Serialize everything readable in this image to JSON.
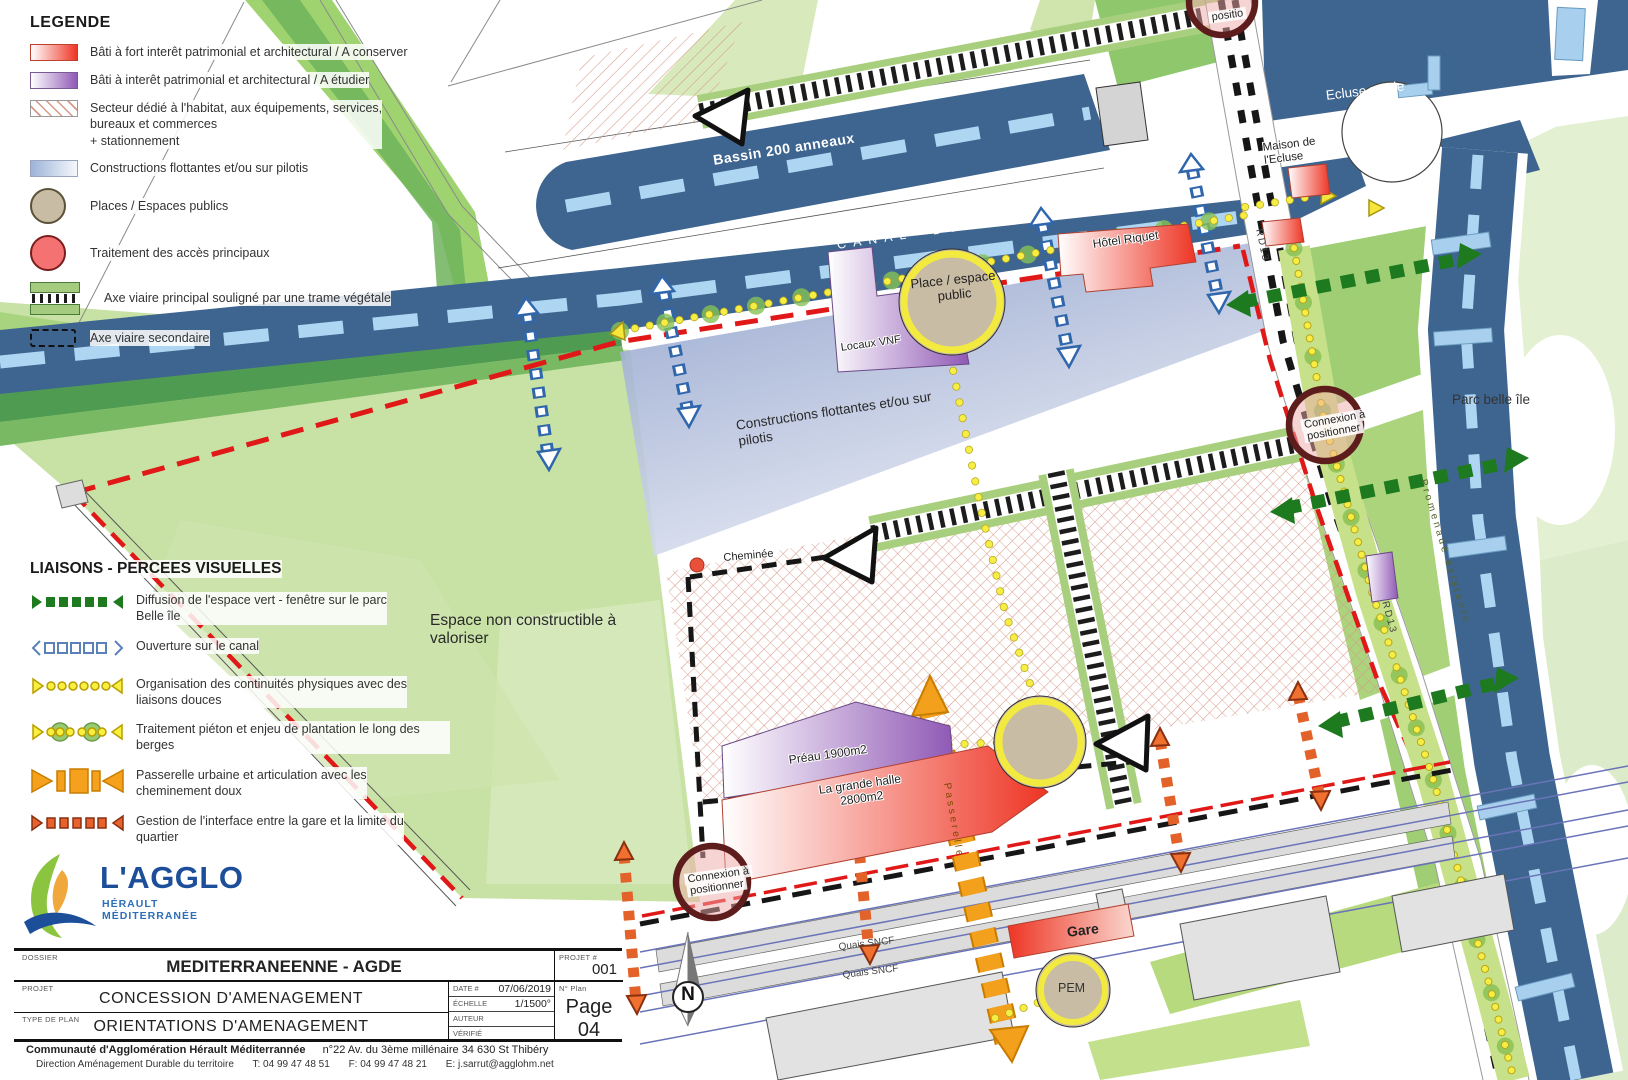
{
  "legend": {
    "title": "LEGENDE",
    "items": [
      {
        "icon": "red-gradient-swatch",
        "label": "Bâti à fort interêt patrimonial et architectural / A conserver"
      },
      {
        "icon": "purple-gradient-swatch",
        "label": "Bâti à interêt patrimonial et architectural / A étudier"
      },
      {
        "icon": "hatched-swatch",
        "label": "Secteur dédié à l'habitat, aux équipements, services,\nbureaux et commerces\n+ stationnement"
      },
      {
        "icon": "blue-gradient-swatch",
        "label": "Constructions flottantes et/ou sur pilotis"
      },
      {
        "icon": "tan-circle-swatch",
        "label": "Places / Espaces publics"
      },
      {
        "icon": "pink-circle-swatch",
        "label": "Traitement des accès principaux"
      },
      {
        "icon": "ladder-swatch",
        "label": "Axe viaire principal souligné par une trame végétale"
      },
      {
        "icon": "dashed-rect-swatch",
        "label": "Axe viaire secondaire"
      }
    ]
  },
  "liaisons": {
    "title": "LIAISONS - PERCEES VISUELLES",
    "items": [
      {
        "icon": "green-dashed-arrow",
        "label": "Diffusion de l'espace vert - fenêtre sur le parc\nBelle île"
      },
      {
        "icon": "blue-squares-arrow",
        "label": "Ouverture sur le canal"
      },
      {
        "icon": "yellow-dots-arrow",
        "label": "Organisation des continuités physiques avec des\nliaisons douces"
      },
      {
        "icon": "yellow-trees-arrow",
        "label": "Traitement piéton et enjeu de plantation le long des berges"
      },
      {
        "icon": "orange-bridge-arrow",
        "label": "Passerelle urbaine et articulation avec les\ncheminement doux"
      },
      {
        "icon": "orange-squares-arrow",
        "label": "Gestion de l'interface entre la gare et la limite du\nquartier"
      }
    ]
  },
  "map_labels": {
    "bassin": "Bassin 200 anneaux",
    "canal": "CANAL DU MIDI",
    "ecluse_ronde": "Ecluse ronde",
    "maison_ecluse": "Maison de\nl'Ecluse",
    "parc": "Parc belle île",
    "hotel_riquet": "Hôtel Riquet",
    "place_public": "Place / espace\npublic",
    "locaux_vnf": "Locaux VNF",
    "constructions": "Constructions flottantes et/ou sur\npilotis",
    "cheminee": "Cheminée",
    "espace": "Espace non constructible à\nvaloriser",
    "preau": "Préau 1900m2",
    "halle": "La grande halle\n2800m2",
    "connexion_l1": "Connexion à",
    "connexion_l2": "positionner",
    "connexion_partial": "positio",
    "rd13": "RD13",
    "promenade": "Promenade existante",
    "passerelle": "Passerelle",
    "quais": "Quais SNCF",
    "gare": "Gare",
    "pem": "PEM",
    "north": "N"
  },
  "titleblock": {
    "dossier_label": "DOSSIER",
    "dossier": "MEDITERRANEENNE - AGDE",
    "projet_num_label": "PROJET #",
    "projet_num": "001",
    "projet_label": "PROJET",
    "projet": "CONCESSION D'AMENAGEMENT",
    "type_label": "TYPE DE PLAN",
    "type": "ORIENTATIONS D'AMENAGEMENT",
    "date_label": "DATE #",
    "date": "07/06/2019",
    "echelle_label": "ÉCHELLE",
    "echelle": "1/1500°",
    "auteur_label": "AUTEUR",
    "verifie_label": "VÉRIFIÉ",
    "nplan_label": "N° Plan",
    "page": "Page 04"
  },
  "footer": {
    "org": "Communauté d'Agglomération Hérault Méditerrannée",
    "address": "n°22 Av. du 3ème millénaire 34 630 St Thibéry",
    "dept": "Direction Aménagement Durable du territoire",
    "tel": "T: 04 99 47 48 51",
    "fax": "F: 04 99 47 48 21",
    "email": "E: j.sarrut@agglohm.net"
  },
  "logo": {
    "name": "L'AGGLO",
    "sub": "HÉRAULT MÉDITERRANÉE"
  },
  "colors": {
    "water": "#3e6590",
    "water_dash": "#aed6f2",
    "green_light": "#c7e2a4",
    "green_mid": "#9fce74",
    "green_dark": "#4f9b52",
    "red_accent": "#ee3524",
    "purple_accent": "#9059b5",
    "boundary_red": "#e01818",
    "orange": "#f3a01c",
    "yellow_dots": "#f6ee45",
    "tan": "#c9bca4",
    "liaison_green": "#1d7a1f"
  }
}
